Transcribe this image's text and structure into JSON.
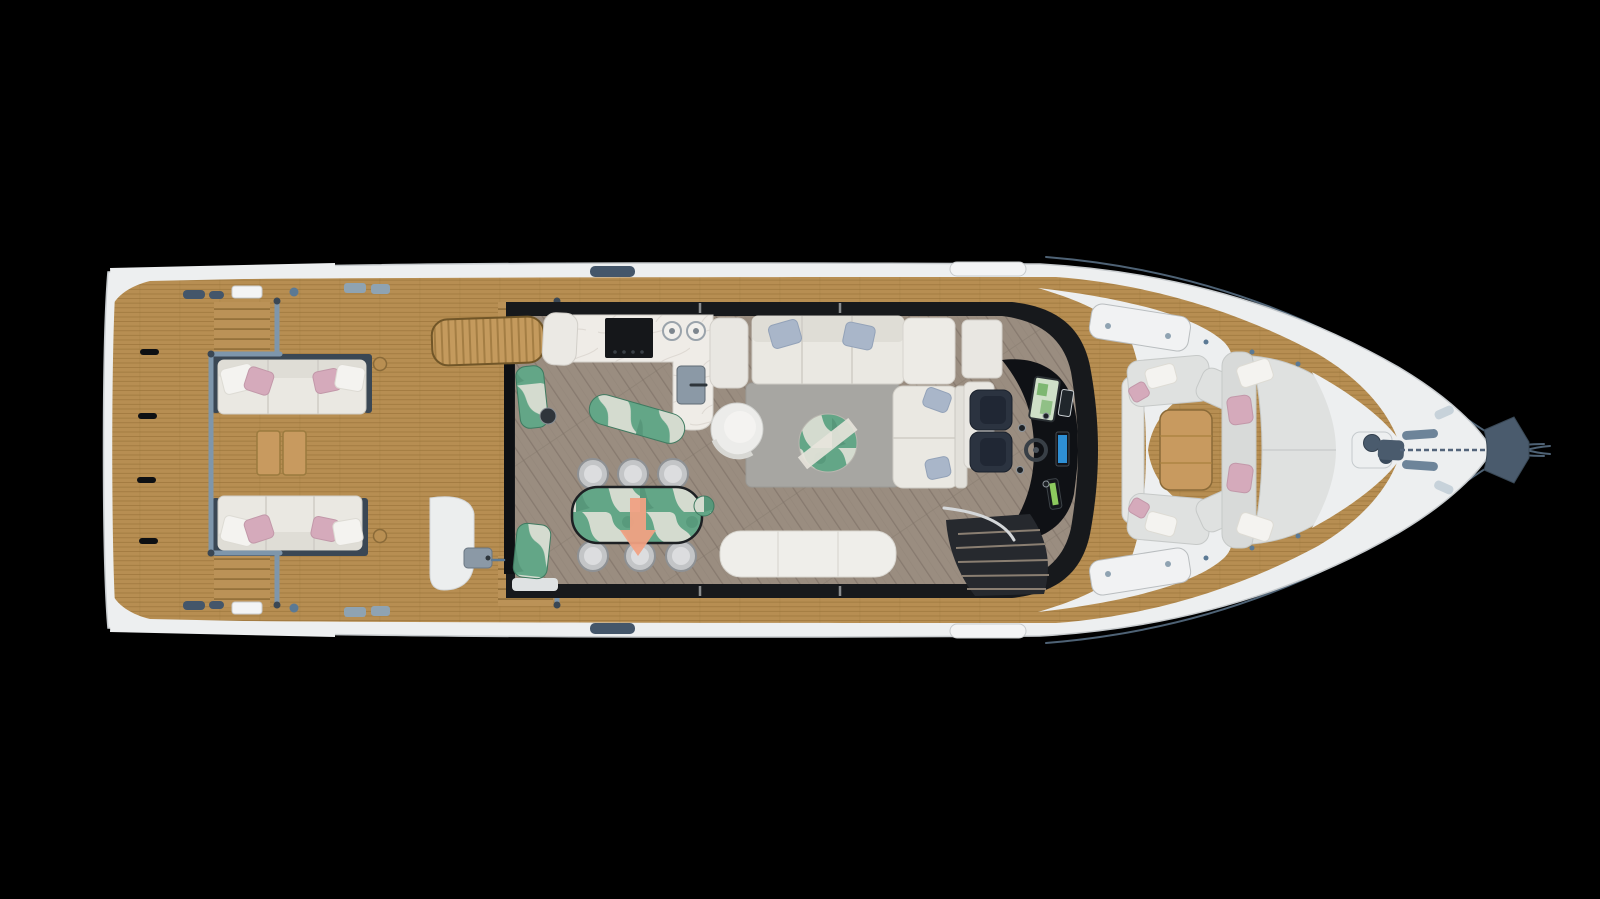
{
  "scene": {
    "subject": "luxury motor yacht main-deck floor plan, top-down 3D render on black",
    "orientation": "bow points right, stern/swim platform at left",
    "areas": {
      "swim_platform": {
        "teak": true,
        "flush_hatch_pulls": 4
      },
      "aft_cockpit": {
        "facing_sofas": 2,
        "seats_per_sofa": 3,
        "pink_pillows": 4,
        "white_pillows": 4,
        "teak_coffee_table_sections": 2,
        "boarding_gates": 2,
        "step_flights": 4
      },
      "boarding": {
        "stowed_passerelle": true
      },
      "galley": {
        "white_marble_l_counter": true,
        "black_cooktop": 1,
        "round_basins": 2,
        "steel_sink": 1,
        "green_marble_island": 1,
        "green_marble_pillars": 2
      },
      "dining": {
        "green_marble_table": 1,
        "chairs": 6,
        "salmon_arrow_overlay": "points aft (down in image)"
      },
      "salon": {
        "l_sofa_pillows_blue": 4,
        "swivel_armchair": 1,
        "round_marble_coffee_table": 1,
        "gray_rug": 1,
        "aft_bench": 1,
        "side_table_green": 1
      },
      "helm": {
        "navy_seats": 2,
        "screens": 3,
        "steering_wheel": 1,
        "throttle": 1,
        "companionway_stairs": 1
      },
      "bow_cockpit": {
        "c_settee": 1,
        "teak_table": 1,
        "sun_pad": 1,
        "pink_pillows": 4,
        "white_pillows": 4
      },
      "foredeck": {
        "white_deck_hatches": 2,
        "windlass": 1,
        "anchor_chain": 1,
        "bow_roller_platform": 1,
        "pulpit_rails": 4
      }
    }
  },
  "colors": {
    "background": "#000000",
    "hull": "#edeff0",
    "hull_stroke": "#c7cbce",
    "teak": "#b78e52",
    "teak_seam": "#8f6c31",
    "teak_step": "#bb9257",
    "tread_seam": "#7c5c28",
    "rung_base": "#c49a5d",
    "rung_seam": "#8a6730",
    "table_teak": "#c89a5f",
    "rail": "#7e96ab",
    "rail_post": "#3a4754",
    "rail_thin": "#4e6275",
    "cabin_shell": "#17191c",
    "door": "#0e1013",
    "floor": "#9a8d80",
    "floor_seam": "#82756a",
    "rug": "#a7a6a2",
    "marble_white": "#efece7",
    "marble_vein": "#d9d5ce",
    "marble_green": "#63a687",
    "marble_green_dark": "#4e8e72",
    "marble_green_vein": "#e8e4dc",
    "cooktop": "#15171a",
    "steel": "#8b99a6",
    "sofa_cream": "#eae8e2",
    "sofa_back": "#dfddd6",
    "pad_gray": "#dfe1e0",
    "pad_edge": "#c6c9c8",
    "backrest_gray": "#d8dad9",
    "pillow_blue": "#a9b6c9",
    "pillow_pink": "#d5aabb",
    "pillow_white": "#f4f3f0",
    "chair_gray": "#c3c5c7",
    "chair_ring": "#8e9194",
    "chair_seat": "#dcdddf",
    "helm_seat": "#2b3340",
    "helm_seat_dark": "#202734",
    "console": "#0f1115",
    "screen_map": "#cfe0c8",
    "screen_map_green": "#6faf62",
    "screen_blue": "#2e8fd4",
    "throttle_green": "#8cc95e",
    "arrow": "#f0a183",
    "stairs": "#26292e",
    "stair_tread": "#8a7f72",
    "handrail": "#d5d8da",
    "hardware_navy": "#44566a",
    "hardware_blue": "#5b7994",
    "hardware_gray": "#8fa3b2",
    "hardware_light": "#c7d2da",
    "white_panel": "#f3f4f5",
    "anchor_navy": "#4a5b6d",
    "armchair": "#ececea",
    "bench_white": "#efeeea",
    "cabinet_white": "#e9e7e2"
  }
}
